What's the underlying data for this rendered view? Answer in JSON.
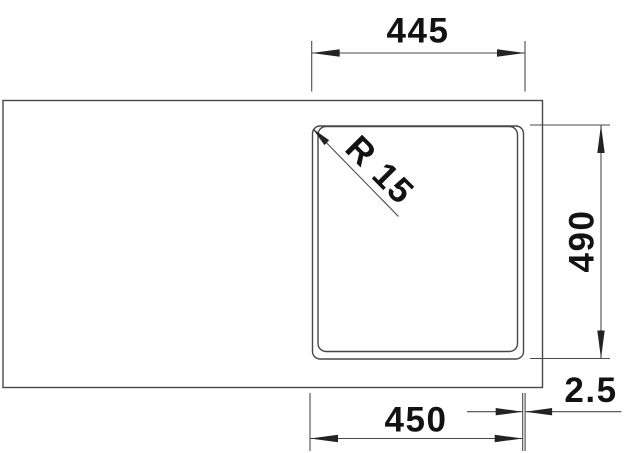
{
  "drawing": {
    "dimensions": {
      "top_width": "445",
      "side_height": "490",
      "bottom_width": "450",
      "edge_offset": "2.5",
      "corner_radius": "R 15"
    },
    "colors": {
      "background": "#ffffff",
      "outline": "#474747",
      "line": "#4a4a4a",
      "arrow": "#232323",
      "text": "#121212"
    }
  }
}
